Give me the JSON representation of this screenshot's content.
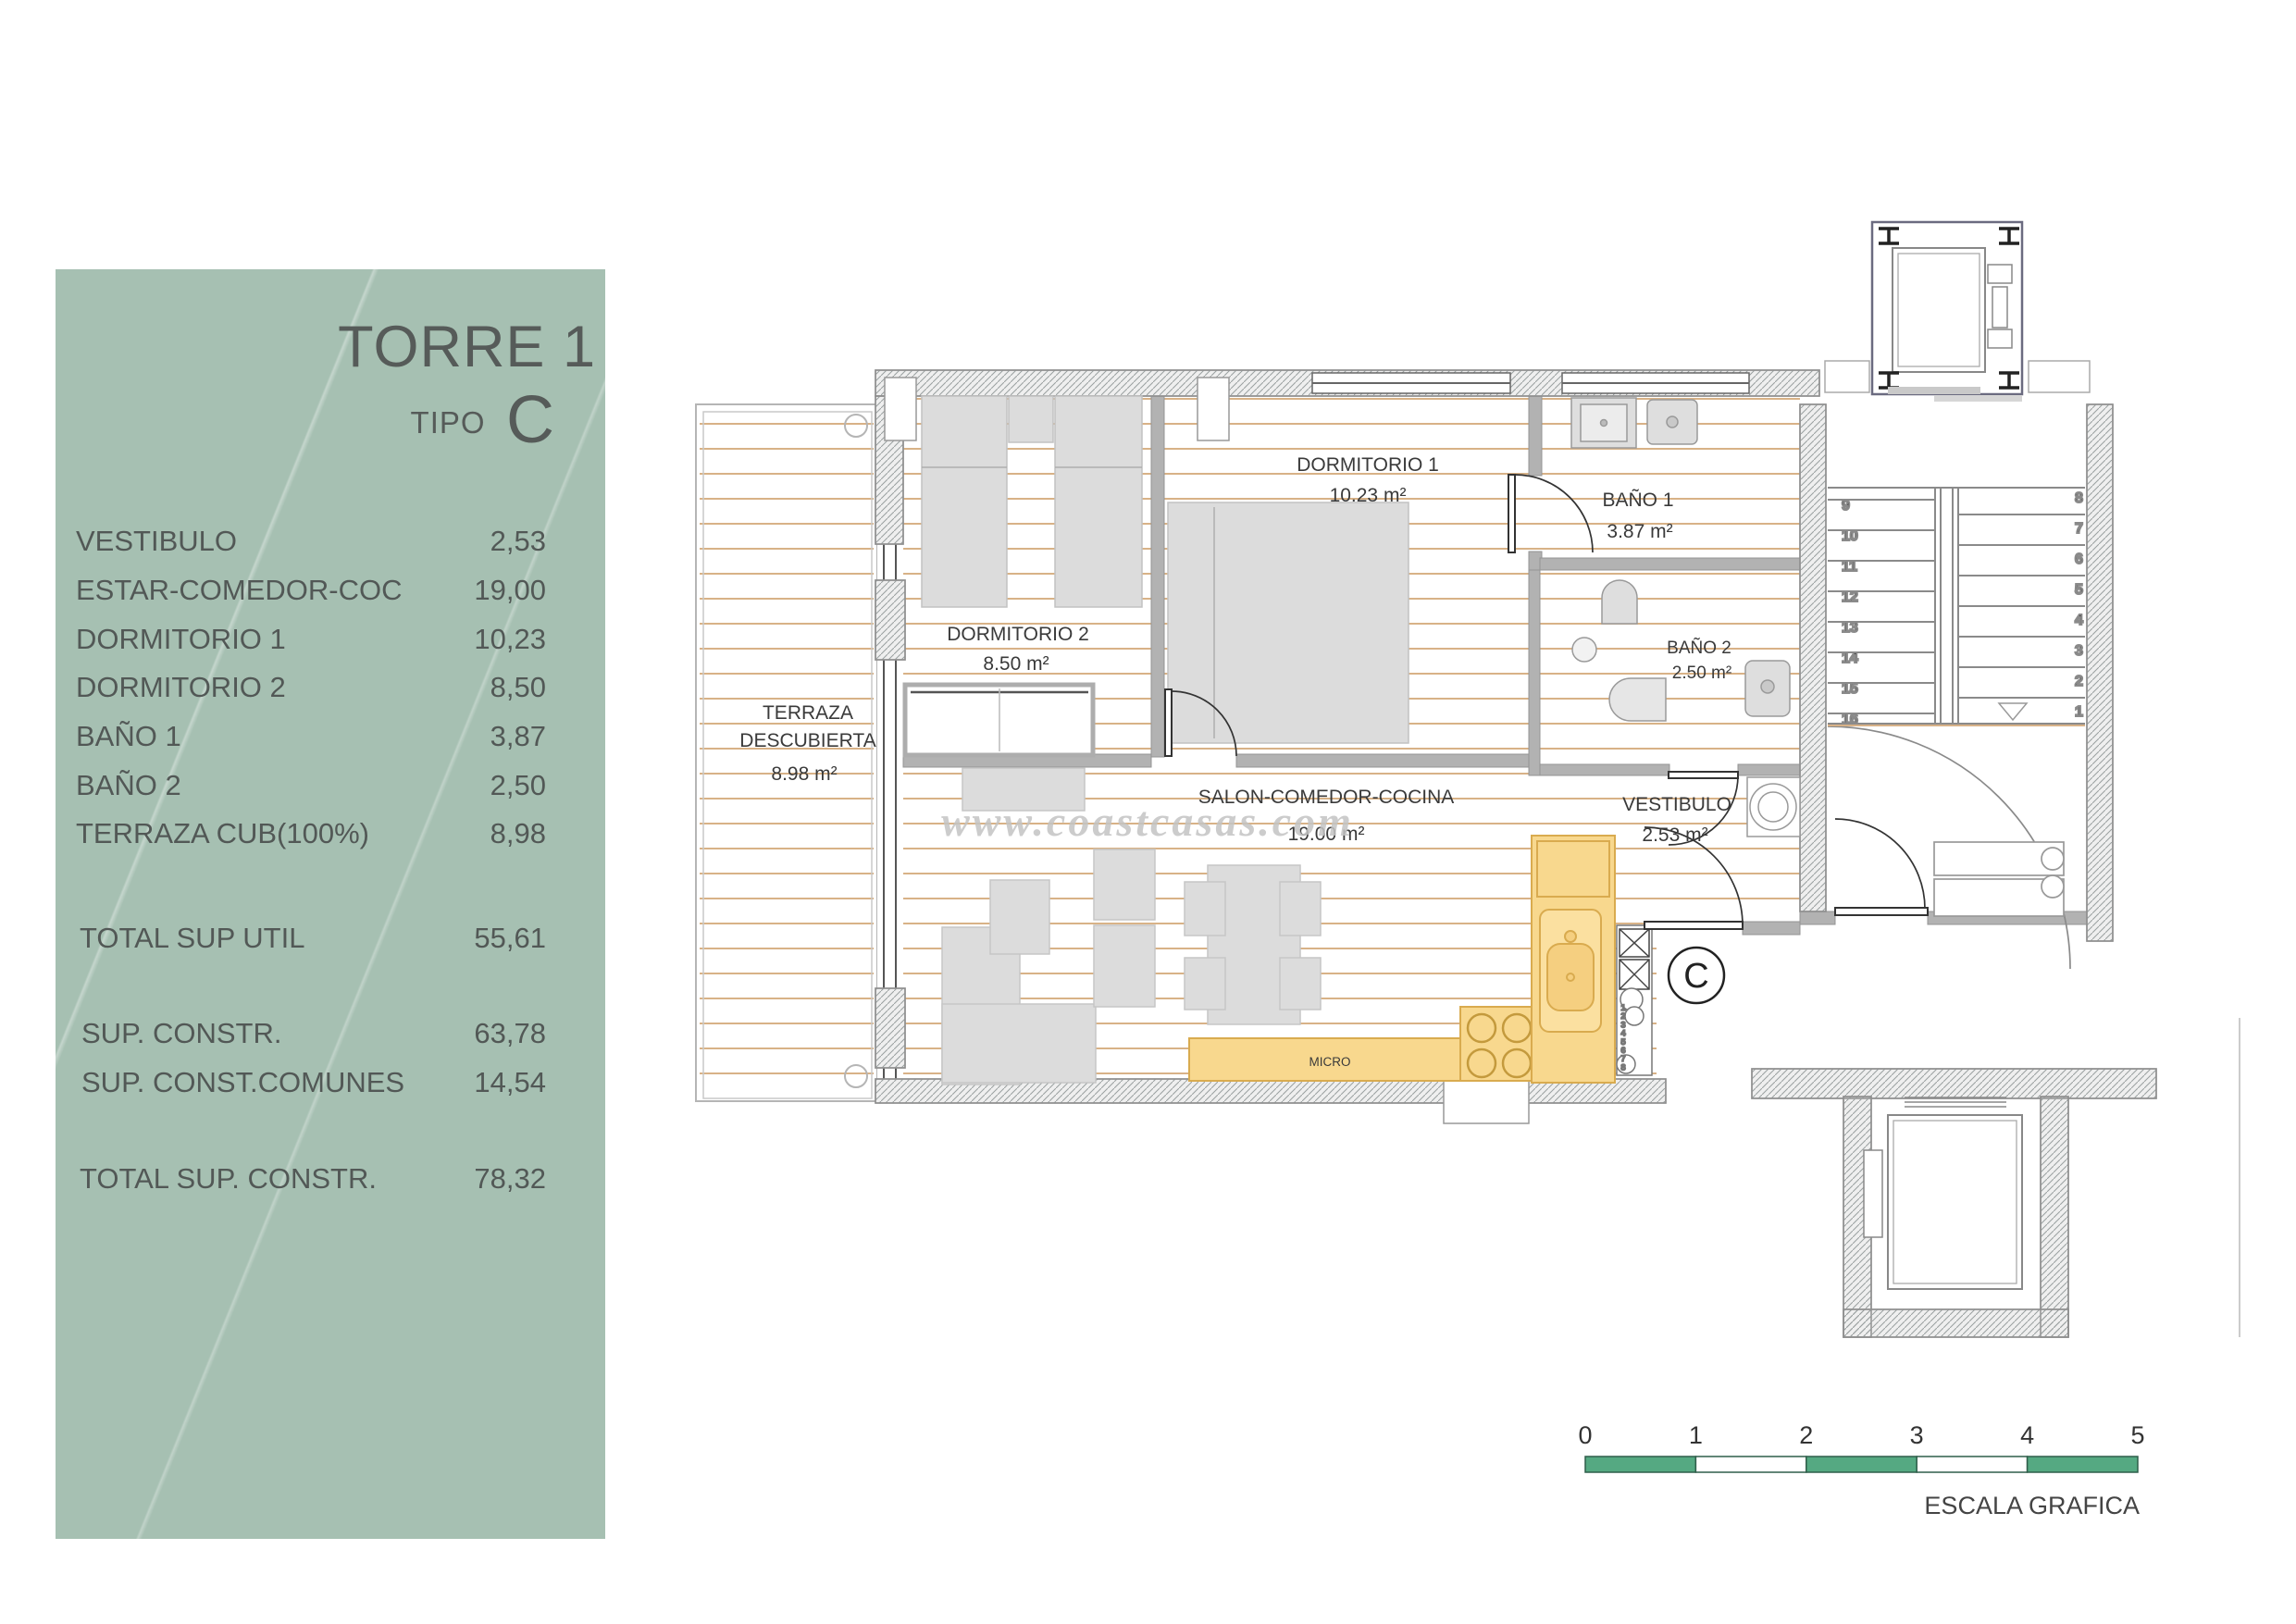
{
  "sidebar": {
    "title": "TORRE 1",
    "subtitle_label": "TIPO",
    "subtitle_value": "C",
    "rooms": [
      {
        "label": "VESTIBULO",
        "value": "2,53"
      },
      {
        "label": "ESTAR-COMEDOR-COC",
        "value": "19,00"
      },
      {
        "label": "DORMITORIO 1",
        "value": "10,23"
      },
      {
        "label": "DORMITORIO 2",
        "value": "8,50"
      },
      {
        "label": "BAÑO 1",
        "value": "3,87"
      },
      {
        "label": "BAÑO 2",
        "value": "2,50"
      },
      {
        "label": "TERRAZA CUB(100%)",
        "value": "8,98"
      }
    ],
    "total_util": {
      "label": "TOTAL SUP UTIL",
      "value": "55,61"
    },
    "constr": [
      {
        "label": "SUP. CONSTR.",
        "value": "63,78"
      },
      {
        "label": "SUP. CONST.COMUNES",
        "value": "14,54"
      }
    ],
    "total_constr": {
      "label": "TOTAL SUP. CONSTR.",
      "value": "78,32"
    }
  },
  "plan": {
    "rooms": {
      "dormitorio1": {
        "name": "DORMITORIO 1",
        "area": "10.23 m²"
      },
      "dormitorio2": {
        "name": "DORMITORIO 2",
        "area": "8.50 m²"
      },
      "bano1": {
        "name": "BAÑO 1",
        "area": "3.87 m²"
      },
      "bano2": {
        "name": "BAÑO 2",
        "area": "2.50 m²"
      },
      "salon": {
        "name": "SALON-COMEDOR-COCINA",
        "area": "19.00 m²"
      },
      "vestibulo": {
        "name": "VESTIBULO",
        "area": "2.53 m²"
      },
      "terraza": {
        "name_line1": "TERRAZA",
        "name_line2": "DESCUBIERTA",
        "area": "8.98 m²"
      }
    },
    "kitchen": {
      "micro_label": "MICRO"
    },
    "unit_letter": "C",
    "stairs": {
      "left_numbers": [
        "9",
        "10",
        "11",
        "12",
        "13",
        "14",
        "15",
        "16"
      ],
      "right_numbers": [
        "8",
        "7",
        "6",
        "5",
        "4",
        "3",
        "2",
        "1"
      ]
    },
    "vent_numbers": [
      "1",
      "2",
      "3",
      "4",
      "5",
      "6",
      "7",
      "8"
    ]
  },
  "watermark": "www.coastcasas.com",
  "scale_bar": {
    "ticks": [
      "0",
      "1",
      "2",
      "3",
      "4",
      "5"
    ],
    "caption": "ESCALA GRAFICA"
  },
  "colors": {
    "sidebar_green": "#a6c0b2",
    "scale_green": "#55a982",
    "floor_line": "#d8b287",
    "kitchen_yellow": "#f8d88e",
    "kitchen_border": "#d9ab4f",
    "wall_gray": "#b2b2b2",
    "furniture_gray": "#dcdcdc",
    "text_dark": "#3c3c3c"
  }
}
